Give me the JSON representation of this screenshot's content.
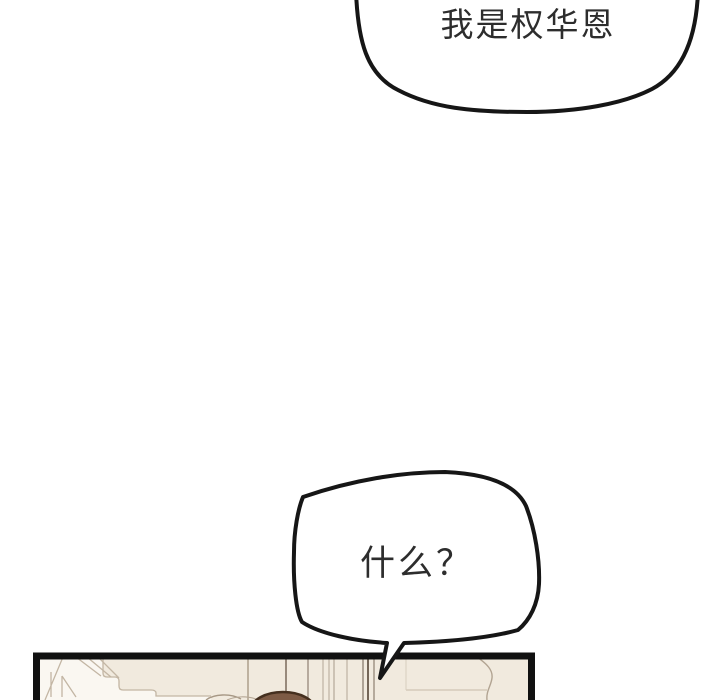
{
  "page": {
    "width": 720,
    "height": 700,
    "background": "#ffffff",
    "type": "webtoon-comic-page-section"
  },
  "bubbles": [
    {
      "name": "top-speech-bubble",
      "text": "我是权华恩",
      "shape": "large rounded oval, clipped by top edge of page",
      "fill": "#ffffff",
      "stroke": "#161616"
    },
    {
      "name": "what-speech-bubble",
      "text": "什么？",
      "shape": "angular rounded hexagon with narrow tail pointing down-left into panel",
      "fill": "#ffffff",
      "stroke": "#161616"
    }
  ],
  "panel": {
    "name": "bottom-comic-panel",
    "description": "top sliver of an interior room scene: white stepped shelf/stair shapes at left, vertical wall and door-frame lines, crown of a brown-haired head at bottom center, curved wall detail at right; panel continues below page edge",
    "background": "#f1eade",
    "border": "#111111",
    "white_shape": "#faf7f1",
    "line_color": "#c3b6a4",
    "dark_line_color": "#6d5f51",
    "hair_fill": "#7d5b45",
    "hair_stroke": "#45301f"
  }
}
